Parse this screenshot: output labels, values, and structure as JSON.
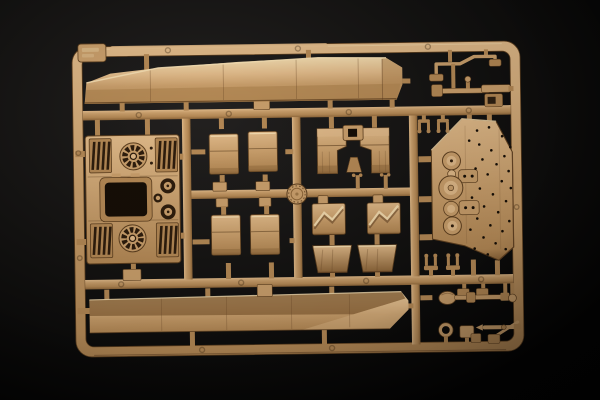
{
  "scene": {
    "type": "photograph",
    "subject": "Tan injection-molded plastic model-kit sprue with armored-vehicle (tank) parts on a black background",
    "parts": [
      "sprue-frame",
      "sprue-tag",
      "runner-grid",
      "upper-hull-side-piece",
      "lower-hull-side-piece",
      "engine-deck with two circular cooling-fan grilles, four intake louver banks, hatch opening and round ports",
      "four curved fender panels",
      "round maker disc",
      "two mirrored angled bracket parts",
      "two stepped plate parts",
      "two scoop parts",
      "large riveted hull side panel with circular bosses",
      "bent rod part",
      "tool rod with pin and ball",
      "mount bracket",
      "four clevis fork parts",
      "shovel with shaft",
      "ring tool",
      "pointed cleaning rod with crossing rod",
      "assorted small blocks and pins"
    ]
  },
  "colors": {
    "bg_outer": "#030303",
    "bg_mid": "#121110",
    "bg_inner": "#232120",
    "tan_hi": "#eed7ab",
    "tan_light": "#ddb787",
    "tan_mid": "#c79d6a",
    "tan_base": "#b28754",
    "tan_shadow": "#8c6539",
    "tan_deep": "#684626",
    "edge": "#5d3f1f",
    "slot": "#2e1d0d",
    "hole": "#160e06",
    "highlight": "#f2dcb0",
    "ej_mark": "rgba(58,37,15,0.45)"
  },
  "side_panel_rivets": [
    [
      478,
      133
    ],
    [
      490,
      130
    ],
    [
      503,
      139
    ],
    [
      511,
      150
    ],
    [
      470,
      143
    ],
    [
      480,
      147
    ],
    [
      492,
      153
    ],
    [
      505,
      159
    ],
    [
      483,
      162
    ],
    [
      497,
      167
    ],
    [
      509,
      174
    ],
    [
      476,
      171
    ],
    [
      488,
      177
    ],
    [
      502,
      184
    ],
    [
      511,
      191
    ],
    [
      480,
      191
    ],
    [
      493,
      197
    ],
    [
      506,
      204
    ],
    [
      472,
      200
    ],
    [
      484,
      209
    ],
    [
      498,
      215
    ],
    [
      509,
      224
    ],
    [
      477,
      221
    ],
    [
      490,
      228
    ],
    [
      502,
      234
    ],
    [
      470,
      232
    ],
    [
      483,
      240
    ],
    [
      495,
      246
    ],
    [
      505,
      252
    ],
    [
      474,
      251
    ],
    [
      487,
      257
    ]
  ]
}
